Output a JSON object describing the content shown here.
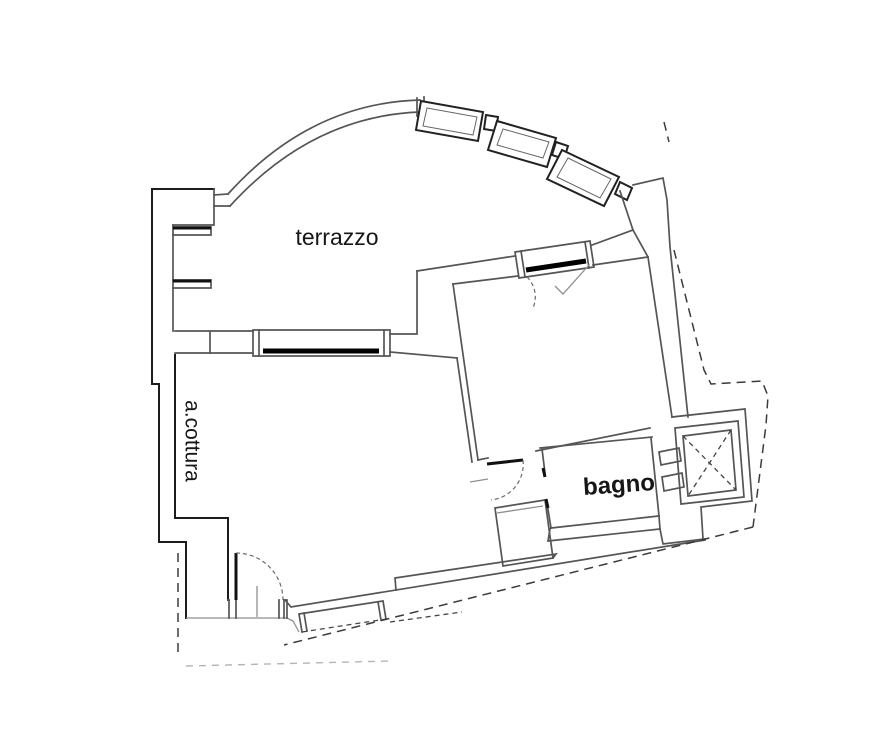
{
  "plan": {
    "type": "apartment-floor-plan",
    "labels": {
      "terrace": "terrazzo",
      "kitchenette": "a.cottura",
      "bathroom": "bagno"
    },
    "colors": {
      "background": "#ffffff",
      "wall_line": "#555555",
      "dark_line": "#1c1c1c",
      "faint_line": "#8f8f8f",
      "text": "#161616"
    }
  }
}
